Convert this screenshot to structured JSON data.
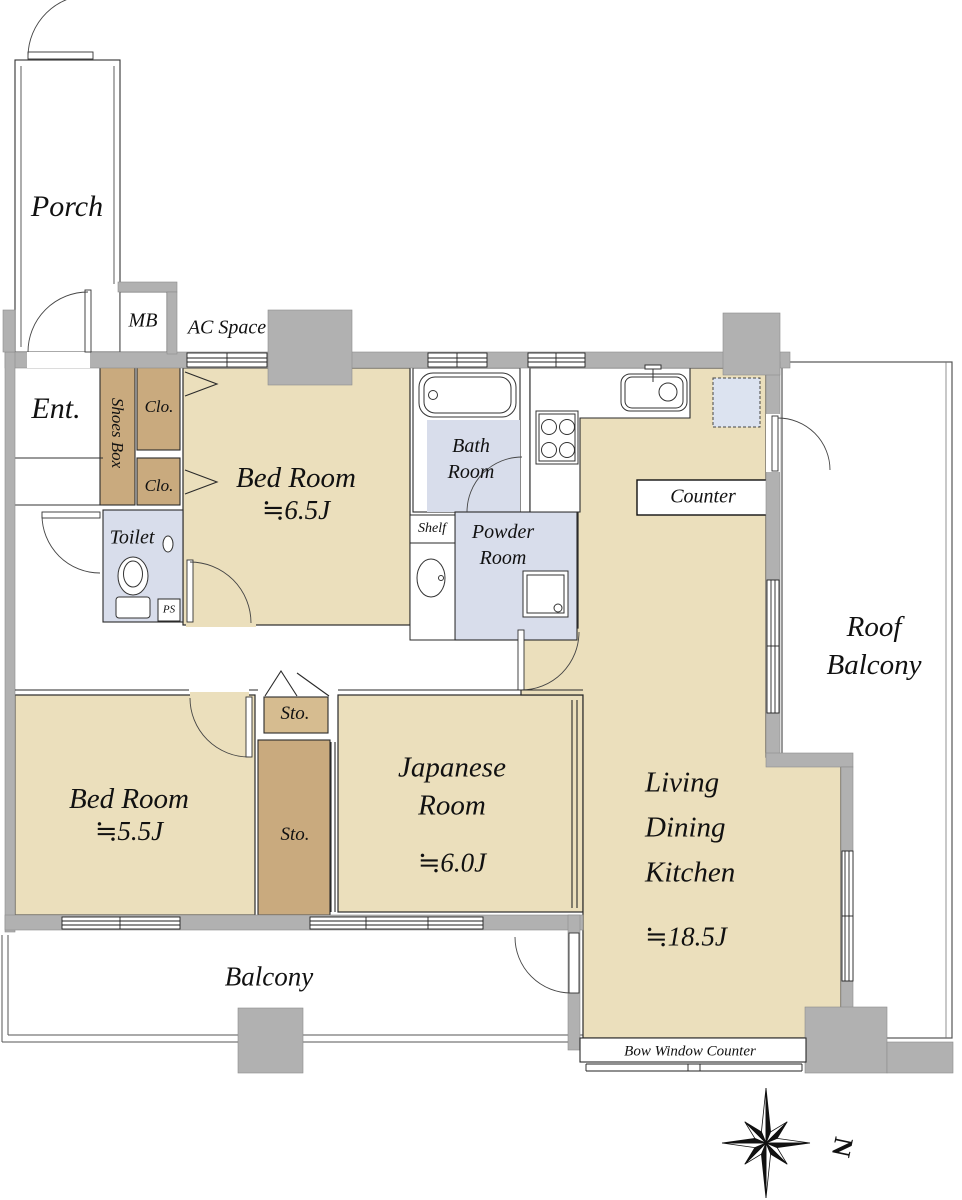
{
  "plan_title": "2LDK + Japanese room apartment floor plan",
  "colors": {
    "room_beige": "#ebdfbc",
    "closet_brown": "#c9aa7e",
    "storage_light_brown": "#d6bc90",
    "wet_area_blue": "#d8ddeb",
    "refrigerator_blue": "#dce3f0",
    "wall_gray": "#b1b1b1",
    "outline": "#2a2a2a"
  },
  "rooms": {
    "porch": {
      "label": "Porch"
    },
    "meter_box": {
      "label": "MB"
    },
    "ac_space": {
      "label": "AC Space"
    },
    "entrance": {
      "label": "Ent."
    },
    "shoes_box": {
      "label": "Shoes Box"
    },
    "closet_upper": {
      "label": "Clo."
    },
    "closet_lower": {
      "label": "Clo."
    },
    "bedroom_main": {
      "label": "Bed Room",
      "size": "≒6.5J"
    },
    "bathroom": {
      "label": "Bath\nRoom"
    },
    "shelf": {
      "label": "Shelf"
    },
    "powder_room": {
      "label": "Powder\nRoom"
    },
    "toilet": {
      "label": "Toilet"
    },
    "pipe_shaft": {
      "label": "PS"
    },
    "counter": {
      "label": "Counter"
    },
    "roof_balcony": {
      "label": "Roof\nBalcony"
    },
    "bedroom_second": {
      "label": "Bed Room",
      "size": "≒5.5J"
    },
    "storage_small": {
      "label": "Sto."
    },
    "storage_tall": {
      "label": "Sto."
    },
    "japanese_room": {
      "label": "Japanese\nRoom",
      "size": "≒6.0J"
    },
    "living_dining_kitchen": {
      "label": "Living\nDining\nKitchen",
      "size": "≒18.5J"
    },
    "balcony": {
      "label": "Balcony"
    },
    "bow_window_counter": {
      "label": "Bow Window Counter"
    }
  },
  "compass": {
    "north": "N"
  },
  "icons": {
    "bathtub": "bathtub-icon",
    "kitchen_sink": "kitchen-sink-icon",
    "gas_stove": "gas-stove-icon",
    "toilet_bowl": "toilet-icon",
    "washbasin": "washbasin-icon",
    "washing_machine": "washing-machine-icon",
    "refrigerator_space": "refrigerator-space-icon",
    "compass_rose": "compass-rose-icon"
  }
}
